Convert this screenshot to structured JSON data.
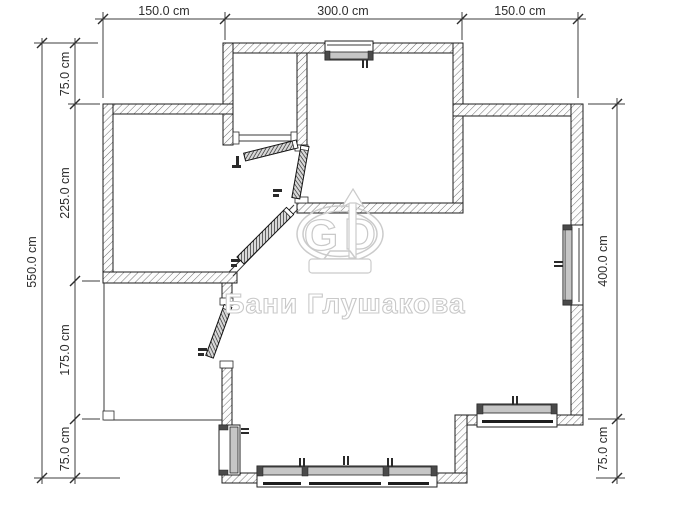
{
  "watermark": {
    "text": "Бани Глушакова",
    "logo": {
      "g": "G",
      "d": "D"
    }
  },
  "dimensions": {
    "unit_note": "cm",
    "top": [
      "150.0 cm",
      "300.0 cm",
      "150.0 cm"
    ],
    "left_outer": "550.0 cm",
    "left_inner": [
      "75.0 cm",
      "225.0 cm",
      "175.0 cm",
      "75.0 cm"
    ],
    "right": [
      "400.0 cm",
      "75.0 cm"
    ]
  },
  "colors": {
    "wall_line": "#1c1c1c",
    "hatch": "#6f6f6f",
    "dimension": "#2e2e2e",
    "watermark": "#c9c9c9",
    "sash": "#c6c6c6",
    "background": "#ffffff"
  }
}
